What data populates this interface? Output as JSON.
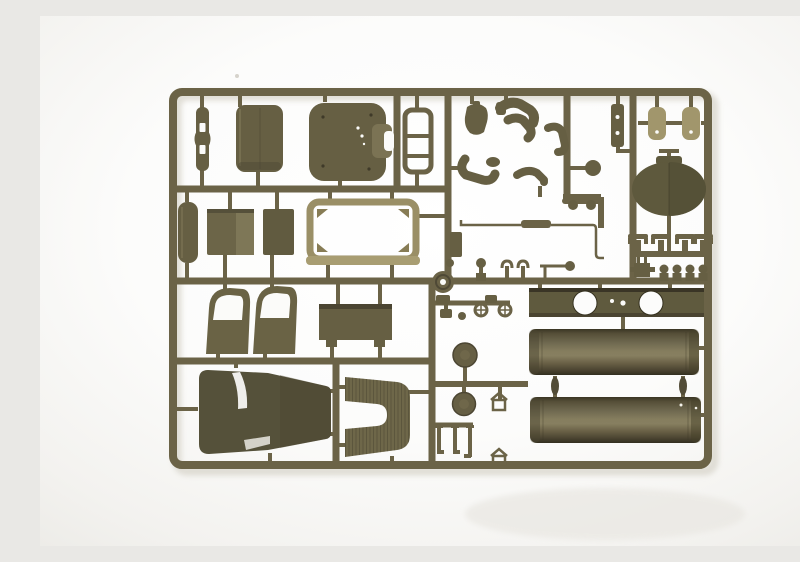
{
  "meta": {
    "description": "Studio photograph of an olive-drab injection-molded plastic model kit sprue (parts tree) for a military truck, shot on a plain white background. The rectangular runner frame holds cab doors, a windshield frame, seat and roof panels, a hood, a fender, two cylindrical fuel-tank halves, a tank strap plate with two round cutouts, driver-figure limbs, and many small fittings.",
    "subject": "model-kit-sprue",
    "setting": "white seamless studio background",
    "visible_text": "none"
  },
  "colors": {
    "photo_bg": "#fbfbfa",
    "photo_bg_edge": "#eeede9",
    "rail": "#6b6347",
    "edge_dark": "#46402d",
    "part_dark": "#56523a",
    "part_mid": "#665f43",
    "part_mid2": "#7b7354",
    "part_light": "#a1966c",
    "frame_tan": "#9a8f66",
    "frame_tan_hi": "#a89d72",
    "tank_top": "#3a3524",
    "tank_hi": "#8a8160",
    "tank_bottom": "#332f20",
    "white_cutout": "#fbfbf9",
    "shadow": "#d9d6cc"
  },
  "parts_inventory": [
    {
      "id": "sprue-frame",
      "desc": "rectangular olive runner frame with internal cross rails"
    },
    {
      "id": "narrow-bracket",
      "desc": "slim vertical bracket with two slot holes, top-left cell"
    },
    {
      "id": "seat-back-panel",
      "desc": "rounded rectangular seat back panel"
    },
    {
      "id": "roof-panel",
      "desc": "rounded square cab panel with side tab and ejector marks"
    },
    {
      "id": "radiator-frame",
      "desc": "small open ladder frame with cross bars"
    },
    {
      "id": "figure-torso",
      "desc": "driver figure torso"
    },
    {
      "id": "figure-legs",
      "desc": "driver figure bent legs"
    },
    {
      "id": "figure-arm-right",
      "desc": "driver figure right arm"
    },
    {
      "id": "figure-leg-bent",
      "desc": "driver figure lower bent leg"
    },
    {
      "id": "figure-arm-left",
      "desc": "driver figure left arm"
    },
    {
      "id": "small-side-panel",
      "desc": "small rectangular panel on center rail"
    },
    {
      "id": "ball-knob",
      "desc": "round ball knob"
    },
    {
      "id": "lever-knobs",
      "desc": "bar with two round knobs"
    },
    {
      "id": "antenna-rod",
      "desc": "long thin rod with thick middle sleeve and bent end"
    },
    {
      "id": "drilled-strip",
      "desc": "vertical strip with two drilled holes"
    },
    {
      "id": "spring-clip-left",
      "desc": "tan spring hanger clip with hole"
    },
    {
      "id": "spring-clip-right",
      "desc": "tan spring hanger clip with hole"
    },
    {
      "id": "air-cleaner-dome",
      "desc": "large oval dome with center seam"
    },
    {
      "id": "valve-fittings",
      "desc": "row of four T-shaped valve fittings"
    },
    {
      "id": "h-bracket",
      "desc": "small H bracket with stub pins"
    },
    {
      "id": "mushroom-knobs",
      "desc": "row of four mushroom-head knobs"
    },
    {
      "id": "running-board",
      "desc": "elongated rounded board, left column"
    },
    {
      "id": "square-panel-large",
      "desc": "large square floor panel, two-tone"
    },
    {
      "id": "square-panel-small",
      "desc": "small rectangular panel"
    },
    {
      "id": "windshield-frame",
      "desc": "large open rounded rectangle frame with corner gussets"
    },
    {
      "id": "door-left",
      "desc": "cab door with open window"
    },
    {
      "id": "door-right",
      "desc": "cab door with open window"
    },
    {
      "id": "toolbox",
      "desc": "rectangular box with two feet"
    },
    {
      "id": "pin-ball",
      "desc": "pin with ball head"
    },
    {
      "id": "pawn-knob",
      "desc": "pawn-shaped knob"
    },
    {
      "id": "u-clamps",
      "desc": "pair of U-shaped clamps"
    },
    {
      "id": "rod-with-ball",
      "desc": "short rod with ball end"
    },
    {
      "id": "pulley-disc",
      "desc": "disc with center hole"
    },
    {
      "id": "eyelets",
      "desc": "two crossed eyelet rings"
    },
    {
      "id": "cap-and-dot",
      "desc": "small cap with round dot"
    },
    {
      "id": "tank-strap-plate",
      "desc": "long mounting plate with two large round cutouts"
    },
    {
      "id": "tank-half-upper",
      "desc": "cylindrical fuel tank half"
    },
    {
      "id": "tank-half-lower",
      "desc": "cylindrical fuel tank half with rivet specks"
    },
    {
      "id": "tank-cap-disc-upper",
      "desc": "round tank end cap"
    },
    {
      "id": "tank-cap-disc-lower",
      "desc": "round tank end cap"
    },
    {
      "id": "clamp-bracket-upper",
      "desc": "small house-shaped clamp"
    },
    {
      "id": "clamp-bracket-lower",
      "desc": "small house-shaped clamp"
    },
    {
      "id": "mounting-pins",
      "desc": "three footed mounting pins"
    },
    {
      "id": "cab-roof-windshield",
      "desc": "large hood/roof piece with white reflection stripe"
    },
    {
      "id": "fender-arch",
      "desc": "C-shaped ribbed fender arch"
    }
  ]
}
